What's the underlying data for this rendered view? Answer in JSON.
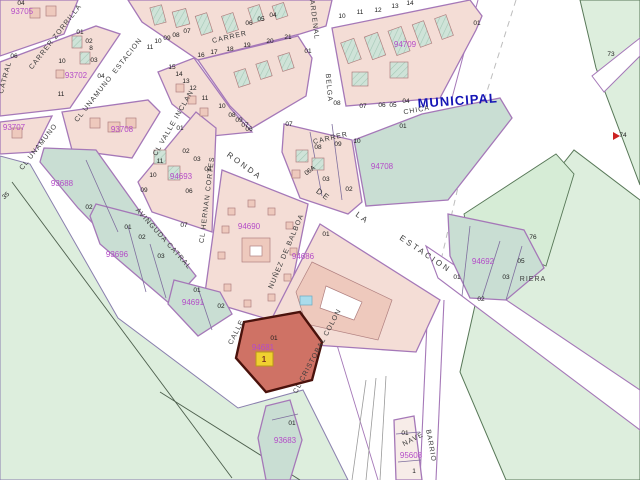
{
  "map": {
    "title": "Cadastral map with selected parcel",
    "municipal": "MUNICIPAL",
    "highlight": {
      "parcel_id": "94681",
      "parcel_number": "01",
      "marker": "1"
    },
    "colors": {
      "block_id_magenta": "#b44cc8",
      "municipal_blue": "#1515b5",
      "highlight_fill": "#cf7265",
      "highlight_outline": "#4a120c",
      "marker_yellow": "#f0d030",
      "rural_green": "#ddeedd",
      "parcel_teal": "#c9ded3",
      "urban_pink": "#f4ddd6",
      "road_purple": "#a578b8"
    },
    "street_labels": [
      {
        "text": "CARRER ZORRILLA",
        "x": 57,
        "y": 38,
        "r": -52
      },
      {
        "text": "CATRAL",
        "x": 7,
        "y": 78,
        "r": -75
      },
      {
        "text": "ESTACION",
        "x": 129,
        "y": 57,
        "r": -52
      },
      {
        "text": "CL UNAMUNO",
        "x": 95,
        "y": 100,
        "r": -52
      },
      {
        "text": "CL UNAMUNO",
        "x": 40,
        "y": 148,
        "r": -52
      },
      {
        "text": "CL VALLE INCLAN",
        "x": 175,
        "y": 124,
        "r": -60
      },
      {
        "text": "CARRER",
        "x": 230,
        "y": 39,
        "r": -13
      },
      {
        "text": "CARDENAL",
        "x": 312,
        "y": 17,
        "r": 83
      },
      {
        "text": "BELGA",
        "x": 327,
        "y": 88,
        "r": 85
      },
      {
        "text": "CARRER",
        "x": 331,
        "y": 140,
        "r": -13
      },
      {
        "text": "CHICA",
        "x": 417,
        "y": 112,
        "r": -10
      },
      {
        "text": "RONDA",
        "x": 243,
        "y": 168,
        "r": 36,
        "big": true
      },
      {
        "text": "DE",
        "x": 322,
        "y": 197,
        "r": 36,
        "big": true
      },
      {
        "text": "LA",
        "x": 361,
        "y": 220,
        "r": 36,
        "big": true
      },
      {
        "text": "ESTACION",
        "x": 424,
        "y": 256,
        "r": 34,
        "big": true
      },
      {
        "text": "CL HERNAN CORTES",
        "x": 209,
        "y": 200,
        "r": -83
      },
      {
        "text": "AVINGUDA CATRAL",
        "x": 162,
        "y": 240,
        "r": 48
      },
      {
        "text": "NUÑEZ DE BALBOA",
        "x": 288,
        "y": 252,
        "r": -67
      },
      {
        "text": "CALLE",
        "x": 238,
        "y": 333,
        "r": -63
      },
      {
        "text": "CL CRISTOBAL COLON",
        "x": 319,
        "y": 352,
        "r": -62
      },
      {
        "text": "BARRIO",
        "x": 429,
        "y": 446,
        "r": 80
      },
      {
        "text": "NAVE",
        "x": 414,
        "y": 441,
        "r": -28
      },
      {
        "text": "RIERA",
        "x": 533,
        "y": 281,
        "r": 0
      }
    ],
    "block_ids": [
      {
        "id": "93705",
        "x": 22,
        "y": 14
      },
      {
        "id": "93702",
        "x": 76,
        "y": 78
      },
      {
        "id": "93707",
        "x": 14,
        "y": 130
      },
      {
        "id": "93708",
        "x": 122,
        "y": 132
      },
      {
        "id": "93688",
        "x": 62,
        "y": 186
      },
      {
        "id": "94693",
        "x": 181,
        "y": 179
      },
      {
        "id": "93696",
        "x": 117,
        "y": 257
      },
      {
        "id": "94691",
        "x": 193,
        "y": 305
      },
      {
        "id": "94690",
        "x": 249,
        "y": 229
      },
      {
        "id": "94686",
        "x": 303,
        "y": 259
      },
      {
        "id": "94708",
        "x": 382,
        "y": 169
      },
      {
        "id": "94709",
        "x": 405,
        "y": 47
      },
      {
        "id": "94692",
        "x": 483,
        "y": 264
      },
      {
        "id": "94681",
        "x": 263,
        "y": 350
      },
      {
        "id": "93683",
        "x": 285,
        "y": 443
      },
      {
        "id": "95608",
        "x": 411,
        "y": 458
      }
    ],
    "parcel_numbers": [
      {
        "t": "04",
        "x": 21,
        "y": 5
      },
      {
        "t": "06",
        "x": 14,
        "y": 58
      },
      {
        "t": "01",
        "x": 80,
        "y": 34
      },
      {
        "t": "02",
        "x": 89,
        "y": 43
      },
      {
        "t": "8",
        "x": 91,
        "y": 50
      },
      {
        "t": "03",
        "x": 94,
        "y": 62
      },
      {
        "t": "04",
        "x": 101,
        "y": 78
      },
      {
        "t": "10",
        "x": 62,
        "y": 63
      },
      {
        "t": "11",
        "x": 61,
        "y": 96
      },
      {
        "t": "11",
        "x": 150,
        "y": 49
      },
      {
        "t": "10",
        "x": 158,
        "y": 43
      },
      {
        "t": "09",
        "x": 167,
        "y": 40
      },
      {
        "t": "08",
        "x": 176,
        "y": 37
      },
      {
        "t": "07",
        "x": 187,
        "y": 33
      },
      {
        "t": "06",
        "x": 249,
        "y": 25
      },
      {
        "t": "05",
        "x": 261,
        "y": 21
      },
      {
        "t": "04",
        "x": 273,
        "y": 17
      },
      {
        "t": "16",
        "x": 201,
        "y": 57
      },
      {
        "t": "17",
        "x": 214,
        "y": 54
      },
      {
        "t": "18",
        "x": 230,
        "y": 51
      },
      {
        "t": "19",
        "x": 247,
        "y": 47
      },
      {
        "t": "20",
        "x": 270,
        "y": 43
      },
      {
        "t": "21",
        "x": 288,
        "y": 39
      },
      {
        "t": "01",
        "x": 308,
        "y": 53
      },
      {
        "t": "15",
        "x": 172,
        "y": 69
      },
      {
        "t": "14",
        "x": 179,
        "y": 76
      },
      {
        "t": "13",
        "x": 186,
        "y": 83
      },
      {
        "t": "12",
        "x": 193,
        "y": 90
      },
      {
        "t": "11",
        "x": 205,
        "y": 100
      },
      {
        "t": "10",
        "x": 222,
        "y": 108
      },
      {
        "t": "08",
        "x": 232,
        "y": 117
      },
      {
        "t": "09",
        "x": 239,
        "y": 122
      },
      {
        "t": "07",
        "x": 245,
        "y": 127
      },
      {
        "t": "06",
        "x": 249,
        "y": 131
      },
      {
        "t": "01",
        "x": 180,
        "y": 130
      },
      {
        "t": "10",
        "x": 342,
        "y": 18
      },
      {
        "t": "11",
        "x": 360,
        "y": 14
      },
      {
        "t": "12",
        "x": 378,
        "y": 12
      },
      {
        "t": "13",
        "x": 395,
        "y": 8
      },
      {
        "t": "14",
        "x": 410,
        "y": 5
      },
      {
        "t": "01",
        "x": 477,
        "y": 25
      },
      {
        "t": "08",
        "x": 337,
        "y": 105
      },
      {
        "t": "07",
        "x": 363,
        "y": 108
      },
      {
        "t": "06",
        "x": 382,
        "y": 107
      },
      {
        "t": "05",
        "x": 393,
        "y": 107
      },
      {
        "t": "04",
        "x": 406,
        "y": 103
      },
      {
        "t": "07",
        "x": 289,
        "y": 126
      },
      {
        "t": "08",
        "x": 318,
        "y": 149
      },
      {
        "t": "09",
        "x": 338,
        "y": 146
      },
      {
        "t": "10",
        "x": 357,
        "y": 143
      },
      {
        "t": "01",
        "x": 403,
        "y": 128
      },
      {
        "t": "03",
        "x": 326,
        "y": 181
      },
      {
        "t": "02",
        "x": 349,
        "y": 191
      },
      {
        "t": "06A",
        "x": 311,
        "y": 172,
        "r": -38
      },
      {
        "t": "02",
        "x": 186,
        "y": 153
      },
      {
        "t": "03",
        "x": 197,
        "y": 161
      },
      {
        "t": "04",
        "x": 208,
        "y": 171
      },
      {
        "t": "10",
        "x": 153,
        "y": 177
      },
      {
        "t": "09",
        "x": 144,
        "y": 192
      },
      {
        "t": "06",
        "x": 189,
        "y": 193
      },
      {
        "t": "07",
        "x": 184,
        "y": 227
      },
      {
        "t": "11",
        "x": 160,
        "y": 163
      },
      {
        "t": "02",
        "x": 89,
        "y": 209
      },
      {
        "t": "01",
        "x": 128,
        "y": 229
      },
      {
        "t": "02",
        "x": 142,
        "y": 239
      },
      {
        "t": "03",
        "x": 161,
        "y": 258
      },
      {
        "t": "01",
        "x": 197,
        "y": 292
      },
      {
        "t": "02",
        "x": 221,
        "y": 308
      },
      {
        "t": "01",
        "x": 326,
        "y": 236
      },
      {
        "t": "01",
        "x": 274,
        "y": 340
      },
      {
        "t": "01",
        "x": 457,
        "y": 279
      },
      {
        "t": "02",
        "x": 481,
        "y": 301
      },
      {
        "t": "03",
        "x": 506,
        "y": 279
      },
      {
        "t": "05",
        "x": 521,
        "y": 263
      },
      {
        "t": "76",
        "x": 533,
        "y": 239
      },
      {
        "t": "73",
        "x": 611,
        "y": 56
      },
      {
        "t": "74",
        "x": 623,
        "y": 137
      },
      {
        "t": "35",
        "x": 7,
        "y": 197,
        "r": -40
      },
      {
        "t": "01",
        "x": 292,
        "y": 425
      },
      {
        "t": "01",
        "x": 405,
        "y": 435
      },
      {
        "t": "1",
        "x": 414,
        "y": 473
      }
    ]
  }
}
